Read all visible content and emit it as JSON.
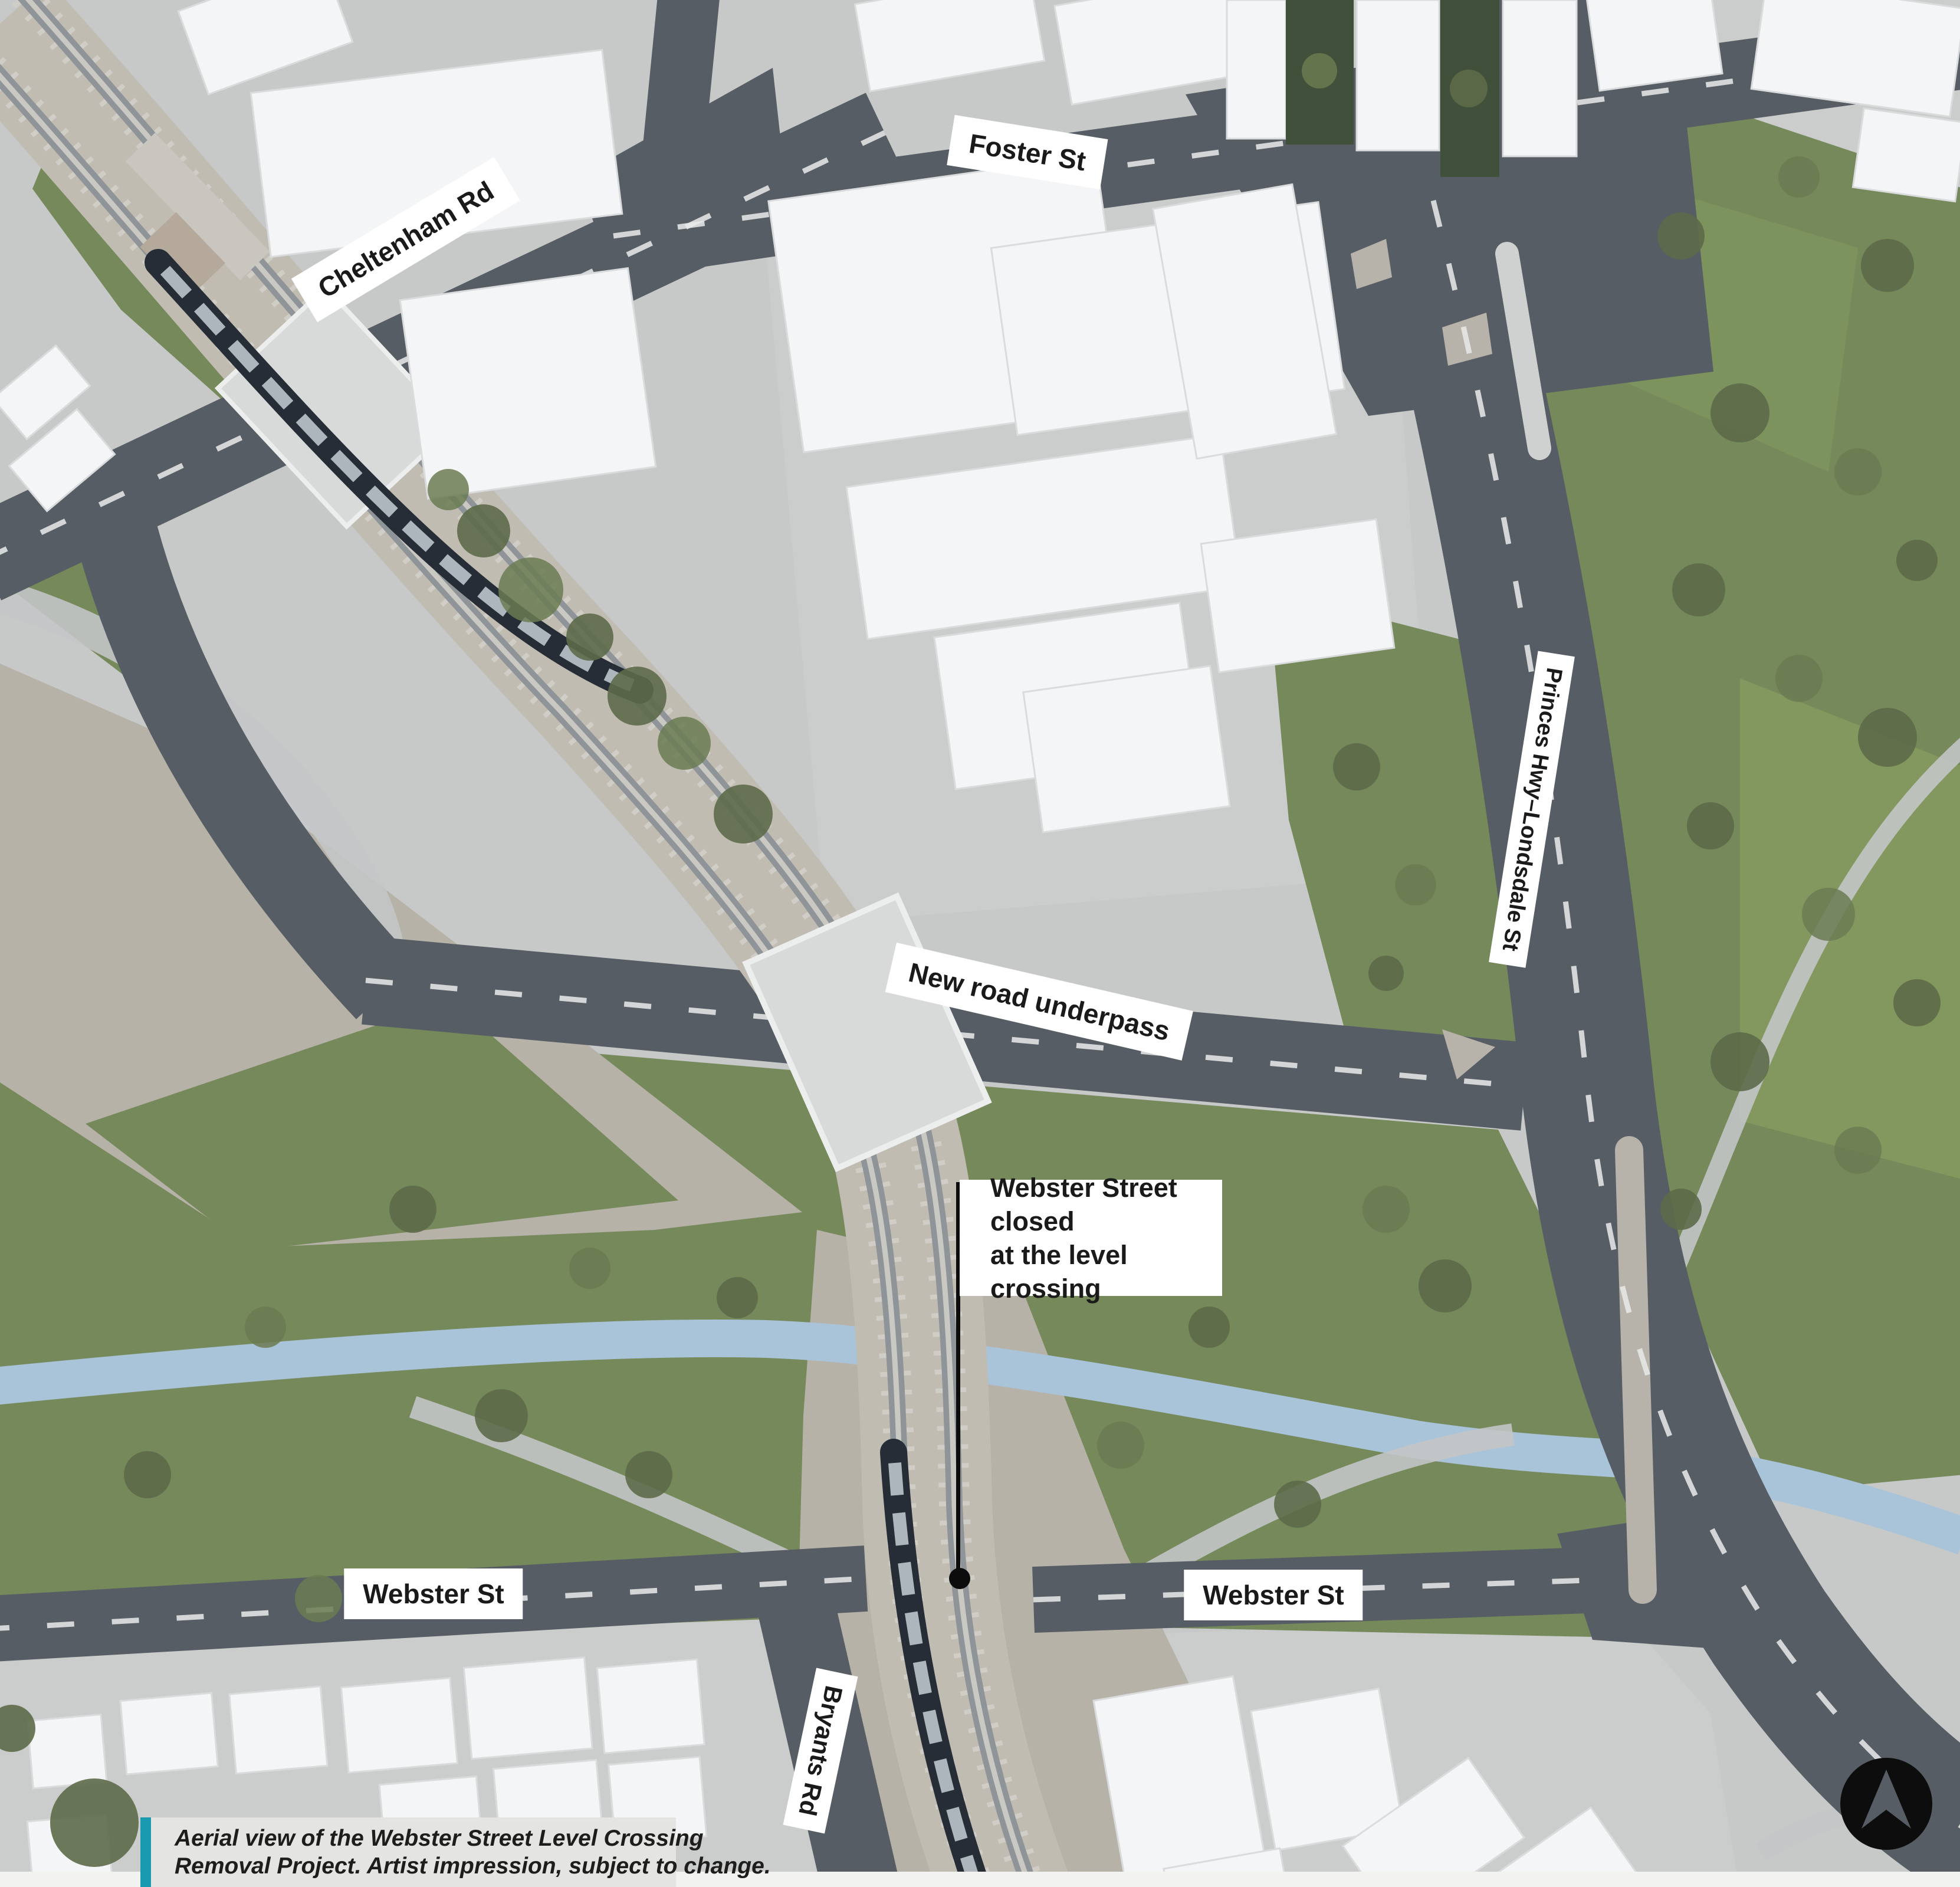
{
  "labels": {
    "foster_st": "Foster St",
    "cheltenham_rd": "Cheltenham Rd",
    "princes_hwy": "Princes Hwy–Londsdale St",
    "new_road_underpass": "New road underpass",
    "webster_closed_line1": "Webster Street closed",
    "webster_closed_line2": "at the level crossing",
    "webster_st_left": "Webster St",
    "webster_st_right": "Webster St",
    "bryants_rd": "Bryants Rd"
  },
  "caption": {
    "line1": "Aerial view of the Webster Street Level Crossing",
    "line2": "Removal Project. Artist impression, subject to change.",
    "accent_color": "#199ab0"
  },
  "icons": {
    "north_arrow": "north-arrow"
  },
  "colors": {
    "road": "#575d64",
    "grass": "#76895b",
    "gravel": "#b7b2a8",
    "creek": "#a9c3d8",
    "building": "#f4f5f6",
    "label_bg": "#ffffff",
    "label_text": "#1a1a1a"
  }
}
